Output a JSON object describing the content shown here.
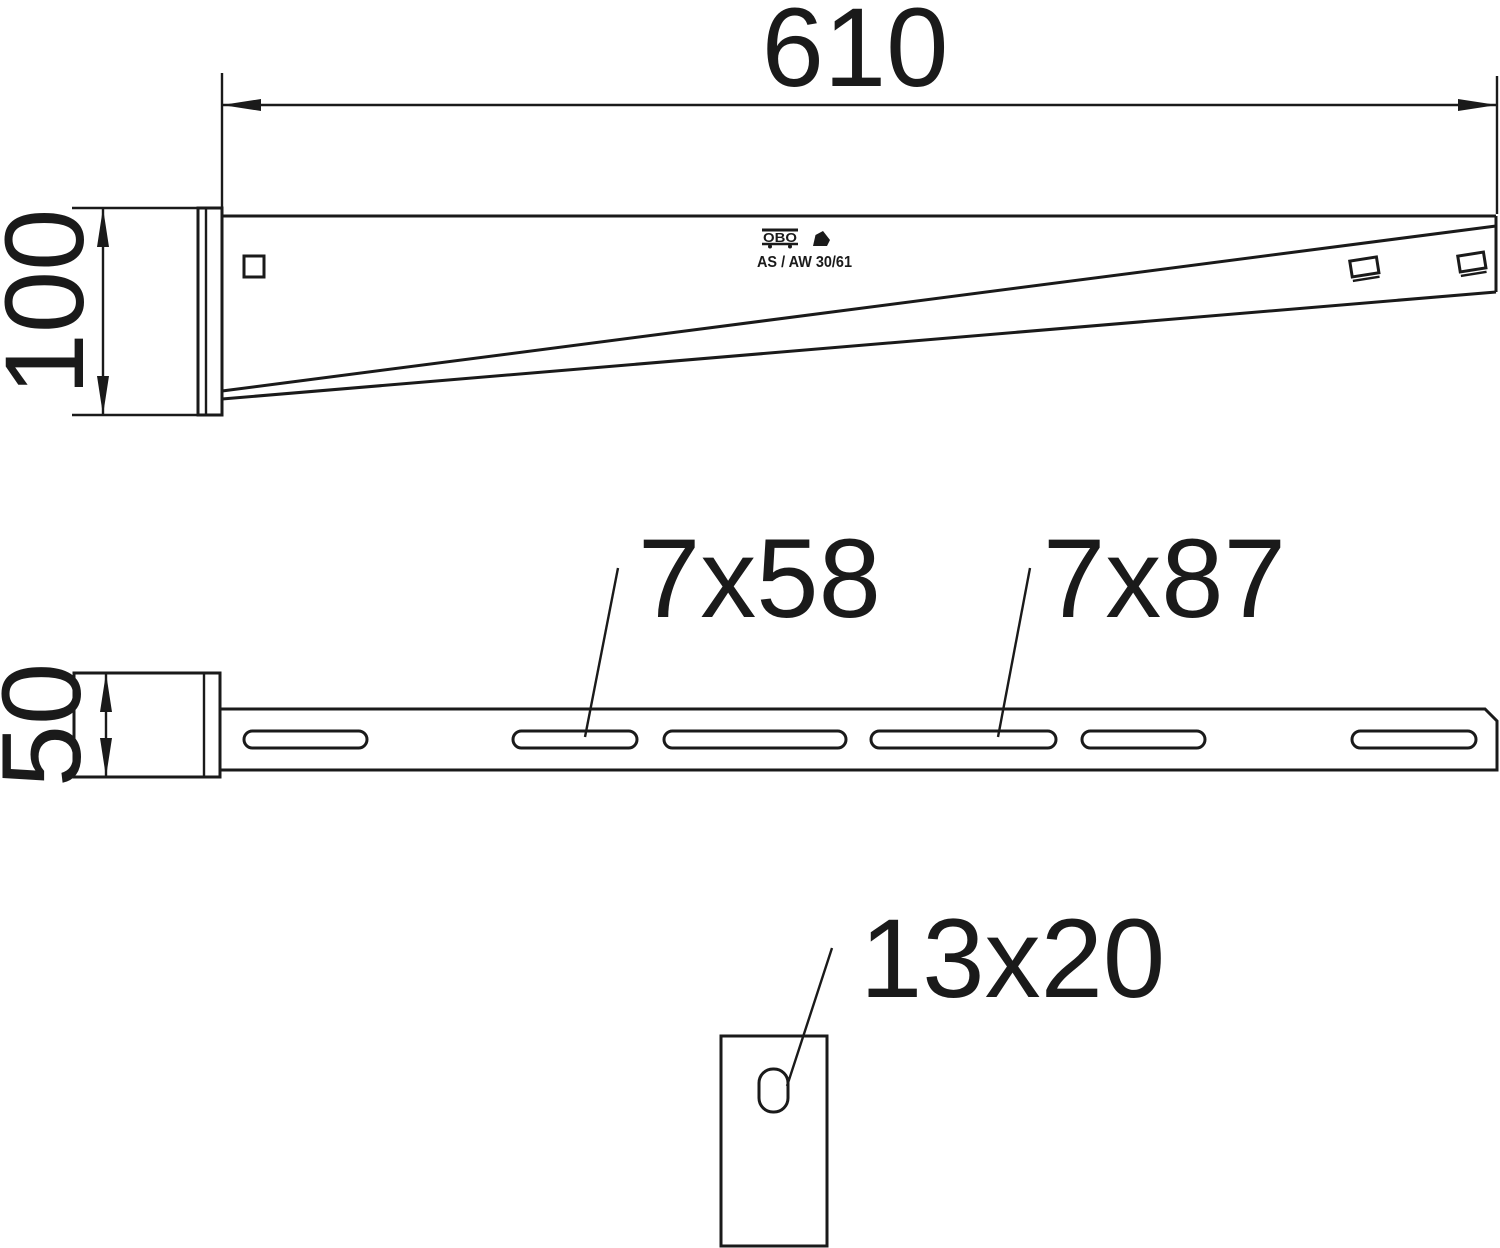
{
  "side": {
    "length_label": "610",
    "height_label": "100",
    "stamp": {
      "brand": "OBO",
      "model": "AS / AW 30/61"
    }
  },
  "plan": {
    "width_label": "50",
    "slot_short_label": "7x58",
    "slot_long_label": "7x87"
  },
  "plate": {
    "hole_label": "13x20"
  },
  "colors": {
    "line": "#1a1a1a",
    "background": "#ffffff"
  }
}
